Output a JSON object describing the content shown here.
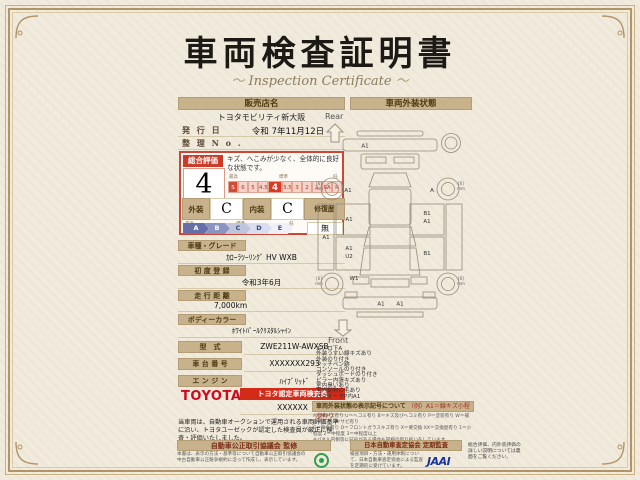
{
  "title": "車両検査証明書",
  "subtitle": "Inspection Certificate",
  "left": {
    "dealer_header": "販売店名",
    "dealer_name": "トヨタモビリティ新大阪",
    "issue_label": "発 行 日",
    "issue_value": "令和 7年11月12日",
    "serial_label": "整 理 N o .",
    "serial_value": "",
    "eval": {
      "overall_label": "総合評価",
      "comment": "キズ、へこみが少なく、全体的に良好な状態です。",
      "score": "4",
      "scale_high": "最高",
      "scale_mid": "標準",
      "scale_low": "低",
      "scale": [
        "S",
        "6",
        "5",
        "4.5",
        "4",
        "3.5",
        "3",
        "2",
        "1",
        "RA",
        "R"
      ],
      "exterior_label": "外装",
      "exterior_grade": "C",
      "interior_label": "内装",
      "interior_grade": "C",
      "repair_label": "修復歴",
      "repair_value": "無",
      "grades": [
        "A",
        "B",
        "C",
        "D",
        "E"
      ],
      "grade_high": "最高",
      "grade_mid": "標準",
      "grade_low": "低"
    },
    "specs": [
      {
        "label": "車種・グレード",
        "value": "ｶﾛｰﾗﾂｰﾘﾝｸﾞ HV WXB"
      },
      {
        "label": "初 度 登 録",
        "value": "令和3年6月"
      },
      {
        "label": "走 行 距 離",
        "value": "7,000km"
      },
      {
        "label": "ボディーカラー",
        "value": "ﾎﾜｲﾄﾊﾟｰﾙｸﾘｽﾀﾙｼｬｲﾝ"
      }
    ],
    "fields": [
      {
        "label": "型　式",
        "value": "ZWE211W-AWXSB"
      },
      {
        "label": "車 台 番 号",
        "value": "XXXXXXX293"
      },
      {
        "label": "エ ン ジ ン",
        "value": "ﾊｲﾌﾞﾘｯﾄﾞ"
      }
    ],
    "brand": "TOYOTA",
    "inspector_badge": "トヨタ認定車両検査員",
    "inspector_no": "XXXXXX",
    "disclaimer": "当車両は、自動車オークションで運用される車両評価基準に沿い、トヨタユーゼックが認定した検査員が厳正に検査・評価いたしました。"
  },
  "right": {
    "header": "車両外装状態",
    "rear": "Rear",
    "front": "Front",
    "marks": {
      "rear_bumper": "A1",
      "left_rear_wheel": "A1",
      "right_rear_wheel": "A",
      "left_fender": "A1",
      "left_rear_door": "A1",
      "left_front_door_a": "A1",
      "left_front_door_b": "U2",
      "right_rear_door_a": "B1",
      "right_rear_door_b": "A1",
      "right_front_door": "B1",
      "front_left": "W1",
      "front_bumper_a": "A1",
      "front_bumper_b": "A1",
      "tire": "[6]",
      "tire_unit": "mm"
    },
    "notes": [
      "エアロ下A",
      "外装うすい線キズあり",
      "外装のり付き",
      "タッチペン跡",
      "コンソールのり付き",
      "ダッシュボードのり付き",
      "ピラー内張キズあり",
      "室内臭いあり",
      "室内動物の毛あり",
      "右クオータP内A1"
    ],
    "legend_title": "車両外装状態の表示記号について",
    "legend_example": "（例）A1＝線キズ小程度有り",
    "legend_lines": [
      "A＝線キズ有り U＝ヘコミ有り B＝キズ及びヘコミ有り P＝塗装有り W＝補修跡有り S＝サビ有り",
      "C＝腐食有り O＝フロントガラスキズ有り X＝要交換 XX＝交換歴有り 1＝小程度 2＝中程度 3＝中程度以上",
      "※パネル内側等に記号がある場合も同様の取り扱いをしています。"
    ]
  },
  "footer": {
    "fair_title": "自動車公正取引協議会 監修",
    "fair_text": "本書は、表示の方法・基準等について自動車公正取引協議会の中古自動車公正競争規約に沿って作成し、表示しています。",
    "jaai_title": "日本自動車査定協会 定期監査",
    "jaai_text": "検査項目・方法・運用体制について、日本自動車査定協会による監査を定期的に受けています。",
    "jaai_logo": "JAAI",
    "back_note": "総合評価、内外装評価の詳しい説明については裏面をご覧ください。"
  }
}
